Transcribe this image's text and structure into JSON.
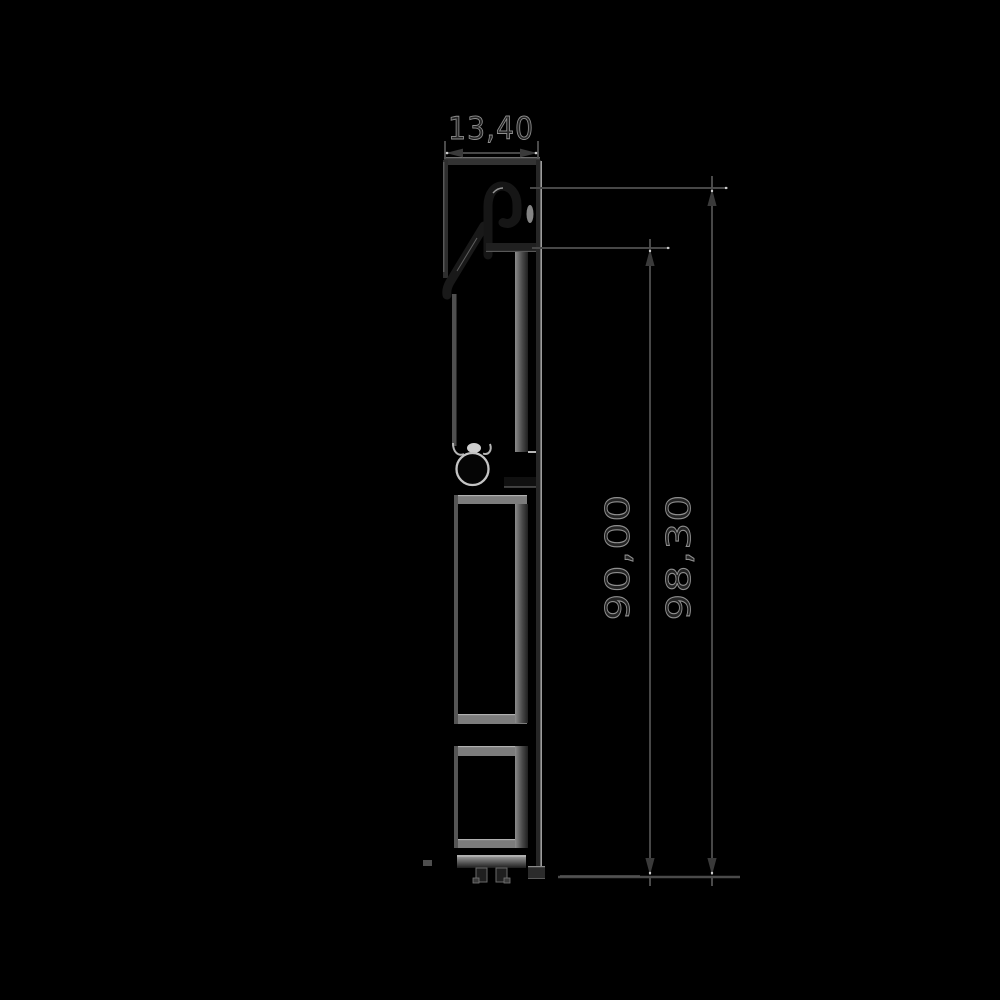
{
  "dimensions": {
    "top_width": "13,40",
    "inner_height": "90,00",
    "outer_height": "98,30"
  },
  "colors": {
    "background": "#000000",
    "dimension_line": "#474747",
    "profile_dark": "#1a1a1a",
    "profile_gray": "#7c7c7c",
    "highlight": "#b5b5b5",
    "text_fill": "#242424",
    "text_outline": "#8f8f8f"
  }
}
